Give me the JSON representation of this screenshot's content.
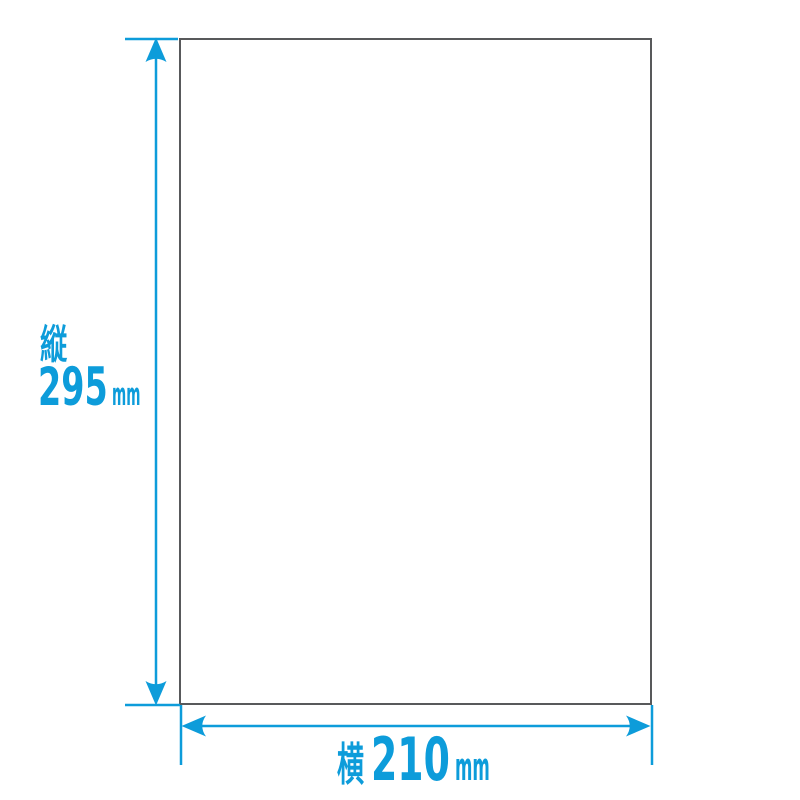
{
  "colors": {
    "accent": "#0d9cda",
    "paper_border": "#58595b",
    "paper_fill": "#ffffff",
    "background": "#ffffff"
  },
  "labels": {
    "height": {
      "axis": "縦",
      "value": "295",
      "unit": "mm"
    },
    "width": {
      "axis": "横",
      "value": "210",
      "unit": "mm"
    }
  }
}
